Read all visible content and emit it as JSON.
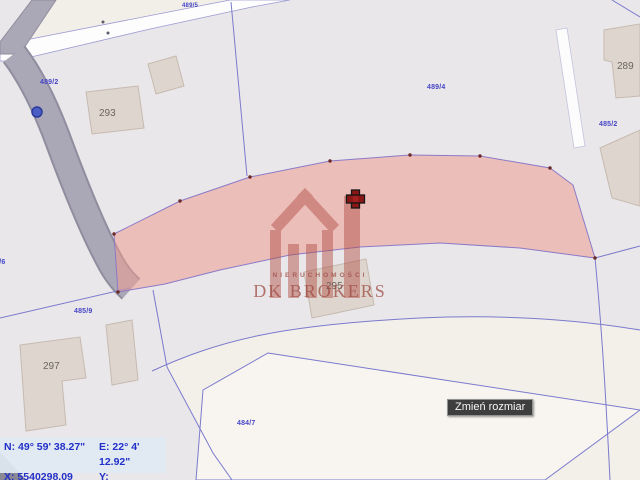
{
  "map": {
    "parcel_labels": [
      {
        "text": "489/2"
      },
      {
        "text": "489/5"
      },
      {
        "text": "489/4"
      },
      {
        "text": "485/2"
      },
      {
        "text": "485/6"
      },
      {
        "text": "485/9"
      },
      {
        "text": "484/7"
      }
    ],
    "building_labels": [
      {
        "text": "293"
      },
      {
        "text": "295"
      },
      {
        "text": "297"
      },
      {
        "text": "289"
      }
    ],
    "watermark": {
      "line1": "NIERUCHOMOŚCI",
      "line2": "DK BROKERS"
    },
    "tooltip": {
      "label": "Zmień rozmiar"
    },
    "coordinates_panel": {
      "n_label": "N:",
      "n_value": "49° 59' 38.27\"",
      "e_label": "E:",
      "e_value": "22° 4' 12.92\"",
      "x_label": "X:",
      "x_value": "5540298.09",
      "y_label": "Y:",
      "y_value": "7576735.69"
    },
    "colors": {
      "highlight_fill": "#f2bfb8",
      "boundary_line": "#7b7acd",
      "label_blue": "#4646c8",
      "label_gray": "#6b645e",
      "watermark_maroon": "#9e4e48",
      "road_fill": "#aaa8b6",
      "marker_cross": "#8b1616"
    }
  }
}
